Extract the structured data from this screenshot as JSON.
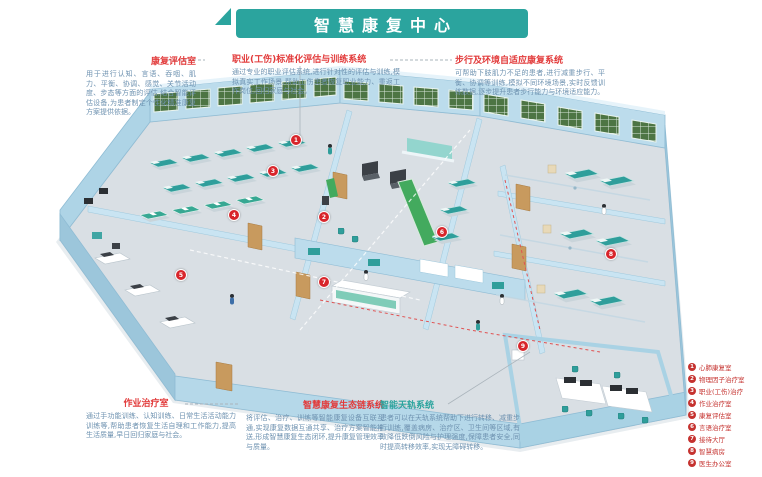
{
  "title": "智慧康复中心",
  "annotations": {
    "tl": {
      "title": "康复评估室",
      "body": "用于进行认知、言语、吞咽、肌力、平衡、协调、感觉、关节活动度、步态等方面的评估,结合智能评估设备,为患者制定个性化精准康复方案提供依据。"
    },
    "tm": {
      "title": "职业(工伤)标准化评估与训练系统",
      "body": "通过专业的职业评估系统,进行针对性的评估与训练,模拟真实工作场景,帮助工伤患者恢复职业能力、重返工作岗位,回归家庭与社会。"
    },
    "tr": {
      "title": "步行及环境自适应康复系统",
      "body": "可帮助下肢肌力不足的患者,进行减重步行、平衡、协调等训练,模拟不同环境场景,实时反馈训练数据,逐步提升患者步行能力与环境适应能力。"
    },
    "bl": {
      "title": "作业治疗室",
      "body": "通过手功能训练、认知训练、日常生活活动能力训练等,帮助患者恢复生活自理和工作能力,提高生活质量,早日回归家庭与社会。"
    },
    "bm": {
      "title": "智慧康复生态链系统",
      "body": "将评估、治疗、训练等智能康复设备互联互通,实现康复数据互通共享、治疗方案智能推送,形成智慧康复生态闭环,提升康复管理效率与质量。"
    },
    "br": {
      "title": "智能天轨系统",
      "body": "患者可以在天轨系统帮助下进行转移、减重步行训练,覆盖病房、治疗区、卫生间等区域,有效降低跌倒风险与护理强度,保障患者安全,同时提高转移效率,实现无障碍转移。"
    }
  },
  "legend": {
    "items": [
      {
        "num": "1",
        "label": "心肺康复室"
      },
      {
        "num": "2",
        "label": "物理因子治疗室"
      },
      {
        "num": "3",
        "label": "职业(工伤)治疗"
      },
      {
        "num": "4",
        "label": "作业治疗室"
      },
      {
        "num": "5",
        "label": "康复评估室"
      },
      {
        "num": "6",
        "label": "言语治疗室"
      },
      {
        "num": "7",
        "label": "接待大厅"
      },
      {
        "num": "8",
        "label": "智慧病房"
      },
      {
        "num": "9",
        "label": "医生办公室"
      }
    ]
  },
  "markers": [
    "1",
    "2",
    "3",
    "4",
    "5",
    "6",
    "7",
    "8",
    "9"
  ],
  "colors": {
    "banner_teal": "#2BA49E",
    "header_red": "#E23B3B",
    "legend_red": "#C5322F",
    "body_text_blue": "#6E92B0",
    "wall_blue": "#BCDCEC",
    "floor_gray": "#D9DFE4",
    "window_green": "#4D7544",
    "equipment_teal": "#2F9E9B",
    "marker_red": "#D8252B"
  }
}
